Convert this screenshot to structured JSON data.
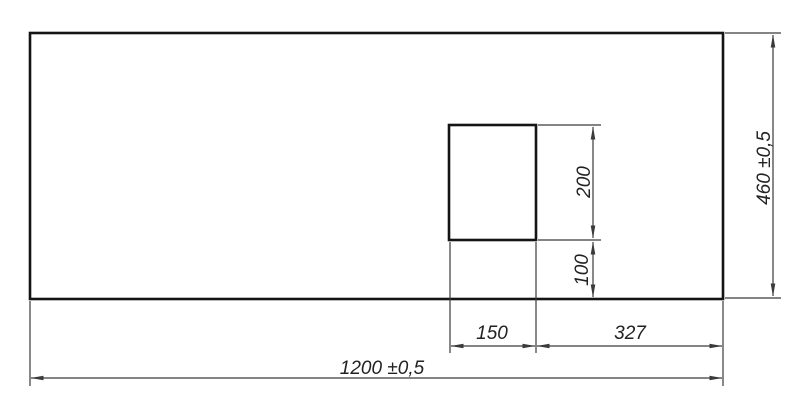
{
  "drawing": {
    "labels": {
      "overall_width": "1200 ±0,5",
      "overall_height": "460 ±0,5",
      "cutout_width": "150",
      "cutout_offset_right": "327",
      "cutout_height": "200",
      "cutout_offset_bottom": "100"
    },
    "dimensions_mm": {
      "overall_width": 1200,
      "overall_height": 460,
      "tolerance": 0.5,
      "cutout_width": 150,
      "cutout_height": 200,
      "cutout_offset_right": 327,
      "cutout_offset_bottom": 100
    },
    "colors": {
      "background": "#ffffff",
      "outline": "#141414",
      "dimension_lines": "#3a3a3a",
      "text": "#222222"
    }
  }
}
